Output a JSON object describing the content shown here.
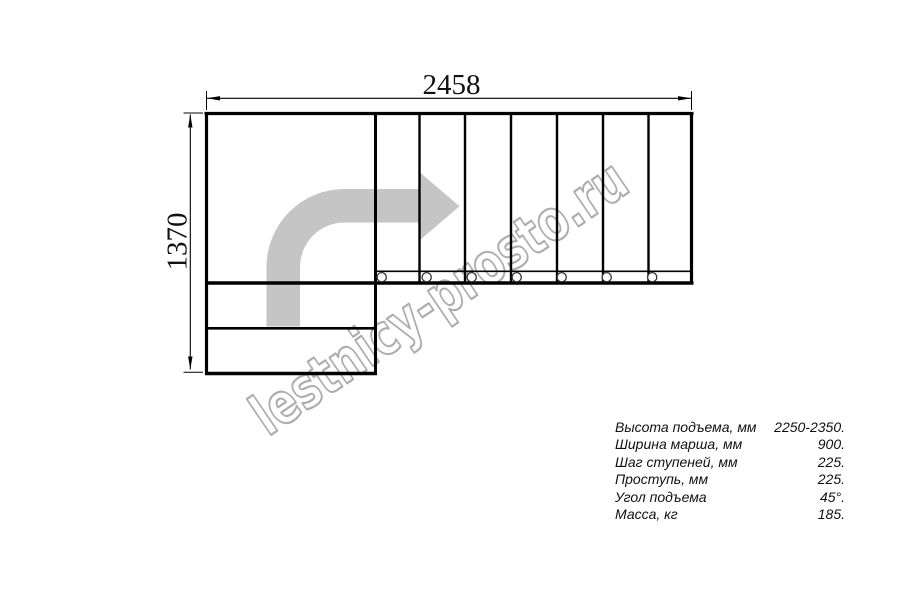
{
  "drawing": {
    "type_note": "L-shaped staircase plan, top view",
    "width_label": "2458",
    "height_label": "1370"
  },
  "watermark": {
    "text": "lestnicy-prosto.ru"
  },
  "specs": {
    "rows": [
      {
        "label": "Высота подъема, мм",
        "value": "2250-2350."
      },
      {
        "label": "Ширина марша, мм",
        "value": "900."
      },
      {
        "label": "Шаг ступеней, мм",
        "value": "225."
      },
      {
        "label": "Проступь, мм",
        "value": "225."
      },
      {
        "label": "Угол подъема",
        "value": "45°."
      },
      {
        "label": "Масса, кг",
        "value": "185."
      }
    ]
  },
  "colors": {
    "line": "#000000",
    "arrow_fill": "#c5c5c5",
    "watermark": "#adadad",
    "background": "#ffffff"
  }
}
